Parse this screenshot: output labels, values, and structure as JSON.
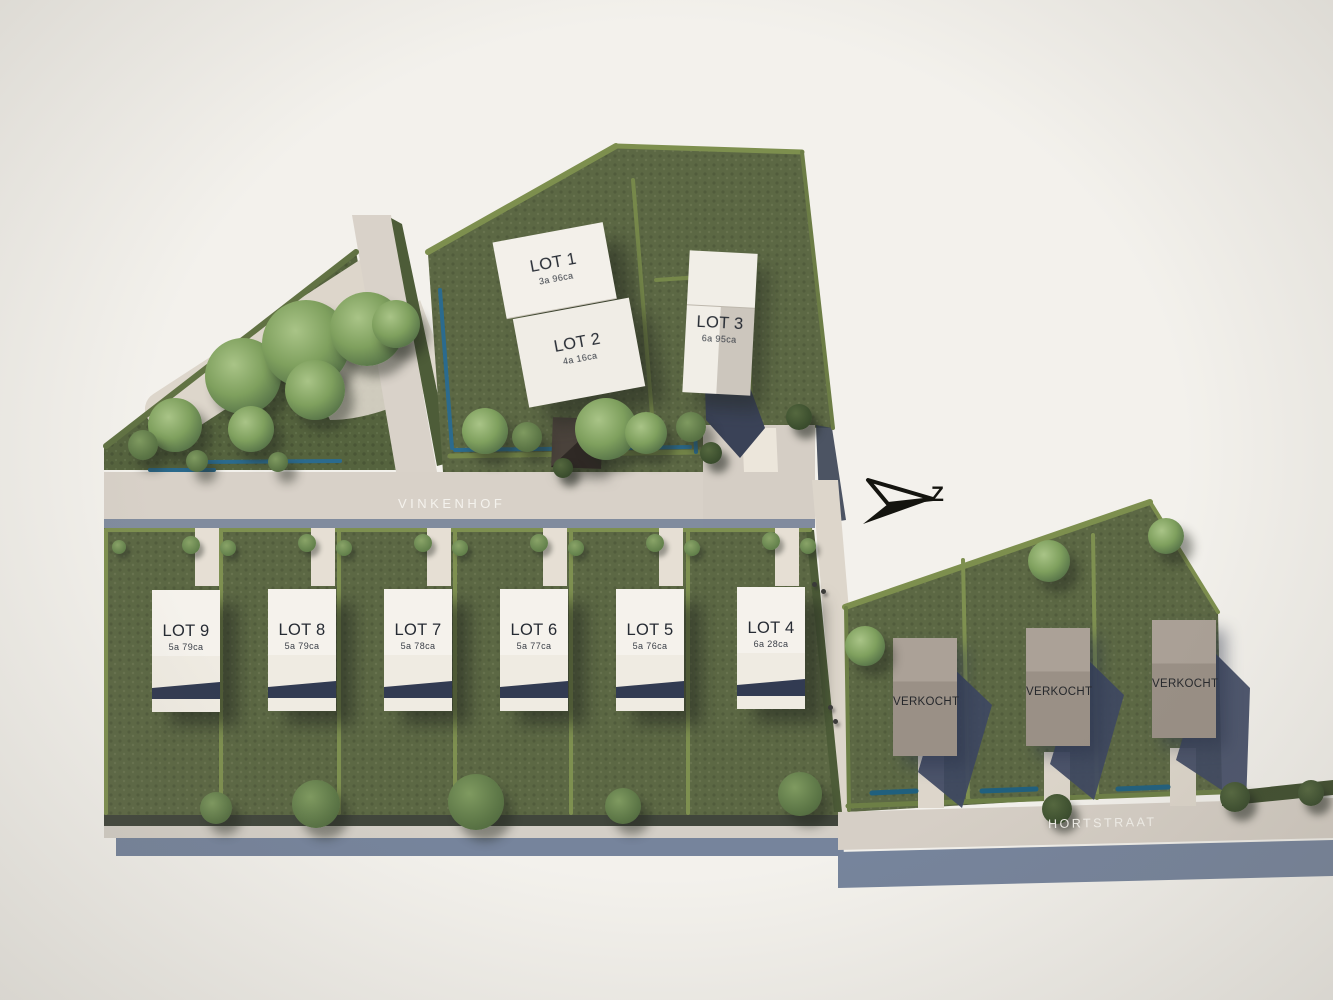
{
  "plan": {
    "type": "residential lot site plan",
    "streets": {
      "vinkenhof": "VINKENHOF",
      "hortstraat": "HORTSTRAAT"
    },
    "compass": {
      "label": "Z"
    },
    "lots": [
      {
        "name": "LOT 1",
        "area": "3a 96ca"
      },
      {
        "name": "LOT 2",
        "area": "4a 16ca"
      },
      {
        "name": "LOT 3",
        "area": "6a 95ca"
      },
      {
        "name": "LOT 4",
        "area": "6a 28ca"
      },
      {
        "name": "LOT 5",
        "area": "5a 76ca"
      },
      {
        "name": "LOT 6",
        "area": "5a 77ca"
      },
      {
        "name": "LOT 7",
        "area": "5a 78ca"
      },
      {
        "name": "LOT 8",
        "area": "5a 79ca"
      },
      {
        "name": "LOT 9",
        "area": "5a 79ca"
      }
    ],
    "sold": {
      "label": "VERKOCHT",
      "count": 3
    },
    "colors": {
      "background": "#f3f1ec",
      "grass": "#5c6844",
      "park_grass": "#57653f",
      "hedge": "#7d8f4e",
      "road": "#d8d1c8",
      "house_white": "#f3f0ea",
      "house_sold": "#9a9086",
      "shadow_navy": "#3a4257",
      "water_blue": "#2b6b8e",
      "slate_band": "#76849c",
      "label_dark": "#262b33",
      "street_text": "#f6f4ef"
    }
  }
}
